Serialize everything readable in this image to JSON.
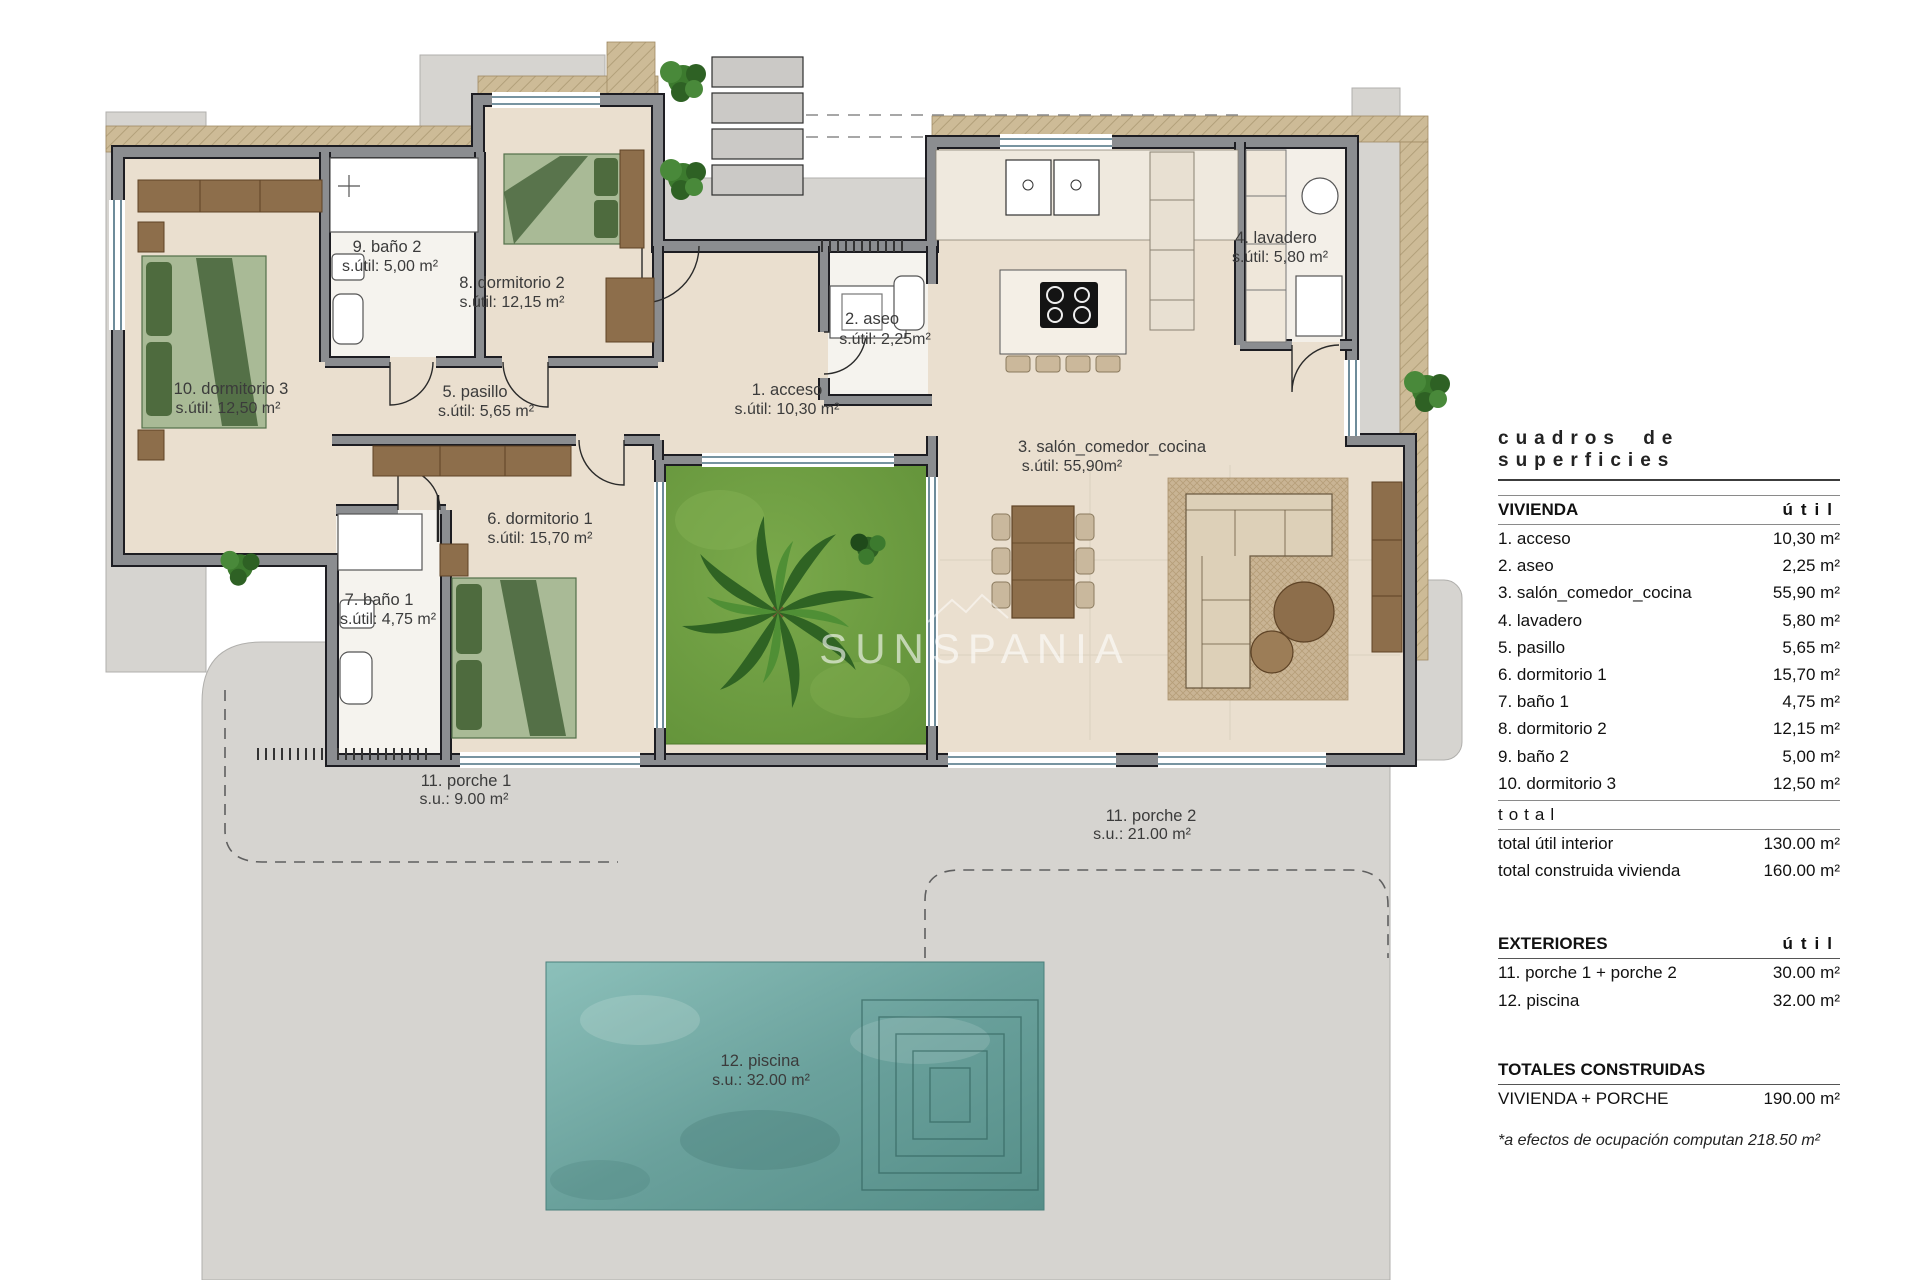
{
  "watermark": {
    "text": "SUNSPANIA"
  },
  "plan": {
    "rooms": [
      {
        "id": "acceso",
        "name": "1. acceso",
        "area": "s.útil: 10,30 m²"
      },
      {
        "id": "aseo",
        "name": "2. aseo",
        "area": "s.útil: 2,25m²"
      },
      {
        "id": "salon",
        "name": "3. salón_comedor_cocina",
        "area": "s.útil: 55,90m²"
      },
      {
        "id": "lavadero",
        "name": "4. lavadero",
        "area": "s.útil: 5,80 m²"
      },
      {
        "id": "pasillo",
        "name": "5. pasillo",
        "area": "s.útil: 5,65 m²"
      },
      {
        "id": "dormitorio1",
        "name": "6. dormitorio 1",
        "area": "s.útil: 15,70 m²"
      },
      {
        "id": "bano1",
        "name": "7. baño 1",
        "area": "s.útil: 4,75 m²"
      },
      {
        "id": "dormitorio2",
        "name": "8. dormitorio 2",
        "area": "s.útil: 12,15 m²"
      },
      {
        "id": "bano2",
        "name": "9. baño 2",
        "area": "s.útil: 5,00 m²"
      },
      {
        "id": "dormitorio3",
        "name": "10. dormitorio 3",
        "area": "s.útil: 12,50 m²"
      },
      {
        "id": "porche1",
        "name": "11. porche 1",
        "area": "s.u.: 9.00 m²"
      },
      {
        "id": "porche2",
        "name": "11. porche 2",
        "area": "s.u.: 21.00 m²"
      },
      {
        "id": "piscina",
        "name": "12. piscina",
        "area": "s.u.: 32.00 m²"
      }
    ]
  },
  "table": {
    "title": "cuadros de superficies",
    "vivienda": {
      "header": "VIVIENDA",
      "util": "útil",
      "rows": [
        {
          "label": "1. acceso",
          "value": "10,30 m²"
        },
        {
          "label": "2. aseo",
          "value": "2,25 m²"
        },
        {
          "label": "3. salón_comedor_cocina",
          "value": "55,90 m²"
        },
        {
          "label": "4. lavadero",
          "value": "5,80 m²"
        },
        {
          "label": "5. pasillo",
          "value": "5,65 m²"
        },
        {
          "label": "6. dormitorio 1",
          "value": "15,70 m²"
        },
        {
          "label": "7. baño 1",
          "value": "4,75 m²"
        },
        {
          "label": "8. dormitorio 2",
          "value": "12,15 m²"
        },
        {
          "label": "9. baño 2",
          "value": "5,00 m²"
        },
        {
          "label": "10. dormitorio 3",
          "value": "12,50 m²"
        }
      ]
    },
    "total": {
      "label": "total",
      "rows": [
        {
          "label": "total útil interior",
          "value": "130.00 m²"
        },
        {
          "label": "total construida vivienda",
          "value": "160.00 m²"
        }
      ]
    },
    "exteriores": {
      "header": "EXTERIORES",
      "util": "útil",
      "rows": [
        {
          "label": "11. porche 1 + porche 2",
          "value": "30.00 m²"
        },
        {
          "label": "12. piscina",
          "value": "32.00 m²"
        }
      ]
    },
    "totales": {
      "header": "TOTALES CONSTRUIDAS",
      "rows": [
        {
          "label": "VIVIENDA + PORCHE",
          "value": "190.00 m²"
        }
      ]
    },
    "note": "*a efectos de ocupación computan 218.50 m²"
  },
  "colors": {
    "terrace": "#d6d4d0",
    "wall": "#8b8d90",
    "floor": "#eadfcf",
    "garden": "#6e9d3f",
    "pool": "#6aa19c",
    "wood": "#8d6e4b",
    "bed": "#a9ba96",
    "label_text": "#3b3b3b"
  }
}
